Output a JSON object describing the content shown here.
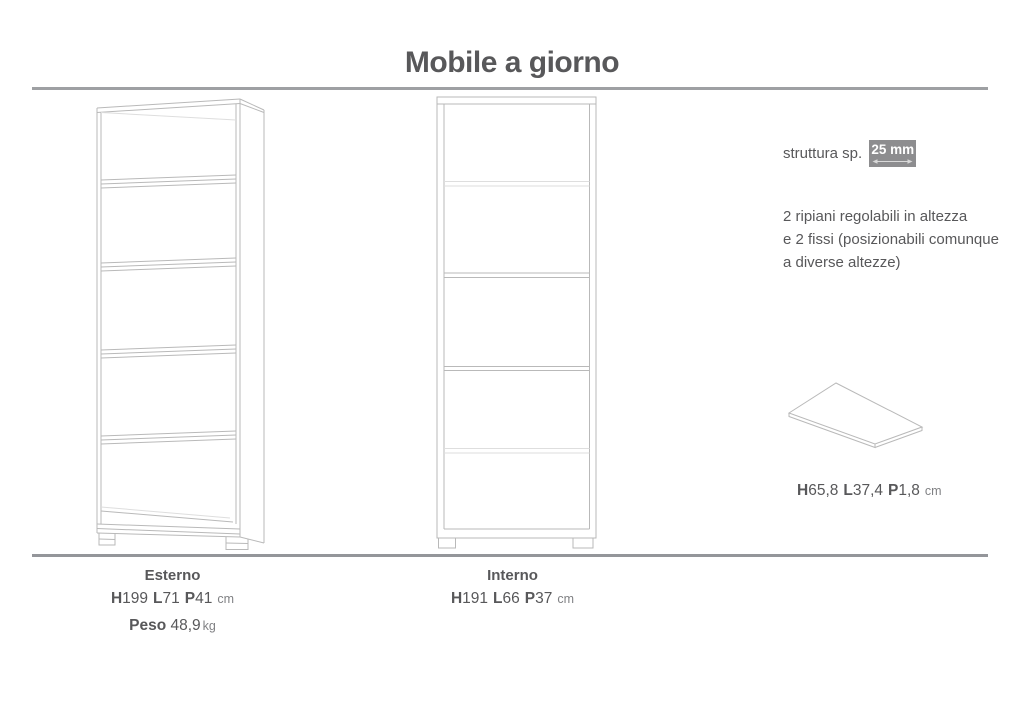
{
  "page": {
    "title": "Mobile a giorno"
  },
  "annotations": {
    "thickness": {
      "label": "struttura sp.",
      "value": "25 mm"
    },
    "shelves_note": "2 ripiani regolabili in altezza\ne 2 fissi (posizionabili comunque\na diverse altezze)",
    "panel_dims": {
      "h_label": "H",
      "h_value": "65,8",
      "l_label": "L",
      "l_value": "37,4",
      "p_label": "P",
      "p_value": "1,8",
      "unit": "cm"
    }
  },
  "specs": {
    "esterno": {
      "title": "Esterno",
      "h_label": "H",
      "h_value": "199",
      "l_label": "L",
      "l_value": "71",
      "p_label": "P",
      "p_value": "41",
      "unit": "cm",
      "weight_label": "Peso",
      "weight_value": "48,9",
      "weight_unit": "kg"
    },
    "interno": {
      "title": "Interno",
      "h_label": "H",
      "h_value": "191",
      "l_label": "L",
      "l_value": "66",
      "p_label": "P",
      "p_value": "37",
      "unit": "cm"
    }
  },
  "colors": {
    "text": "#58585a",
    "unit_text": "#808184",
    "line_art": "#b9b9b9",
    "line_art_light": "#dedede",
    "rule": "#9ea0a3",
    "highlight_box_bg": "#8d8d8f",
    "highlight_box_text": "#ffffff"
  }
}
